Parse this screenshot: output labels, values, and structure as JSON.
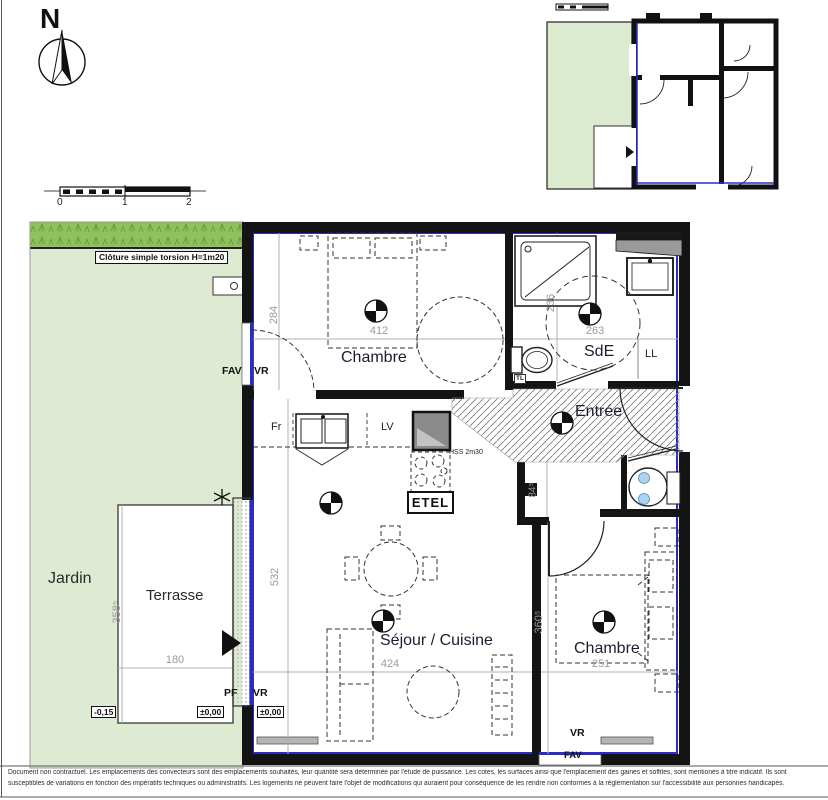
{
  "compass": {
    "north_label": "N"
  },
  "scale_bar": {
    "tick_0": "0",
    "tick_1": "1",
    "tick_2": "2"
  },
  "site": {
    "fence_note": "Clôture simple torsion H=1m20",
    "garden_label": "Jardin",
    "terrace_label": "Terrasse"
  },
  "rooms": {
    "bedroom_1": {
      "name": "Chambre",
      "width": "412",
      "depth": "284"
    },
    "shower_room": {
      "name": "SdE",
      "width": "263",
      "depth": "236"
    },
    "entry": {
      "name": "Entrée"
    },
    "living_kitchen": {
      "name": "Séjour / Cuisine",
      "width": "424",
      "depth": "532"
    },
    "bedroom_2": {
      "name": "Chambre",
      "width": "251",
      "depth": "360⁵"
    },
    "corridor": {
      "depth": "84⁵"
    }
  },
  "terrace_dims": {
    "depth": "358⁵",
    "width": "180"
  },
  "levels": {
    "garden": "-0,15",
    "terrace": "±0,00",
    "interior": "±0,00"
  },
  "equipment": {
    "fridge": "Fr",
    "dishwasher": "LV",
    "washer": "LL",
    "etel": "ETEL",
    "soffit_height": "HSS 2m30",
    "technical_box": "TL"
  },
  "openings": {
    "bedroom1_window_fav": "FAV",
    "bedroom1_window_vr": "VR",
    "living_door_pf": "PF",
    "living_door_vr": "VR",
    "bedroom2_window_vr": "VR",
    "bedroom2_window_fav": "FAV"
  },
  "footer": {
    "line1": "Document non contractuel. Les emplacements des convecteurs sont des emplacements souhaités, leur quantité sera déterminée par l'étude de puissance. Les cotes, les surfaces ainsi que l'emplacement des gaines et soffites, sont mentionés à titre indicatif. Ils sont",
    "line2": "susceptibles de variations en fonction des impératifs techniques ou administratifs. Les logements ne peuvent faire l'objet de modifications qui auraient pour conséquence de les rendre non conformes à la réglementation sur l'accessibilité aux personnes handicapés."
  },
  "colors": {
    "garden_light": "#dfead2",
    "garden_dark": "#8fc25e",
    "unit_outline_blue": "#2b2bcc",
    "wall_black": "#141414",
    "dimension_gray": "#9a9a9a"
  }
}
